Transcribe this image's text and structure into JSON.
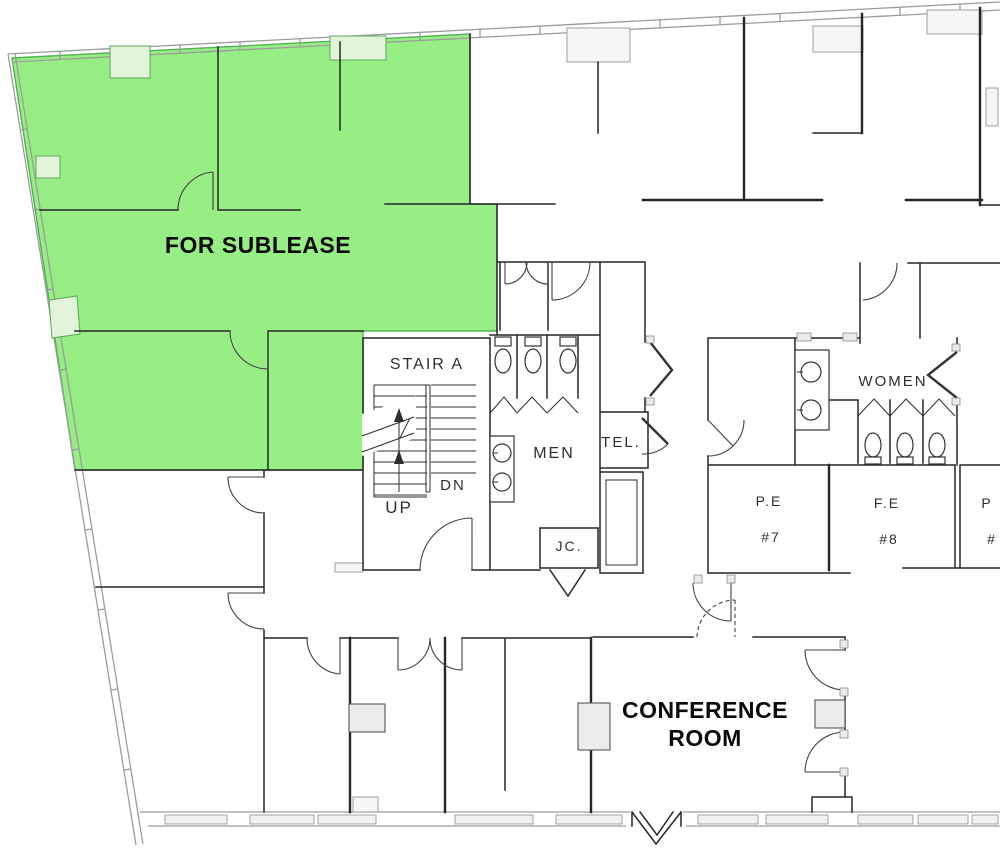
{
  "colors": {
    "highlight_green": "#97ee85",
    "wall_dark": "#262626",
    "shell_gray": "#9c9c9c"
  },
  "areas": {
    "sublease_label": "FOR SUBLEASE"
  },
  "rooms": {
    "stair": {
      "name": "STAIR A",
      "up": "UP",
      "down": "DN"
    },
    "men": {
      "name": "MEN"
    },
    "tel": {
      "name": "TEL."
    },
    "jc": {
      "name": "JC."
    },
    "women": {
      "name": "WOMEN"
    },
    "pe7": {
      "name": "P.E",
      "number": "#7"
    },
    "fe8": {
      "name": "F.E",
      "number": "#8"
    },
    "pe9": {
      "name": "P",
      "number": "#"
    },
    "conference": {
      "line1": "CONFERENCE",
      "line2": "ROOM"
    }
  }
}
